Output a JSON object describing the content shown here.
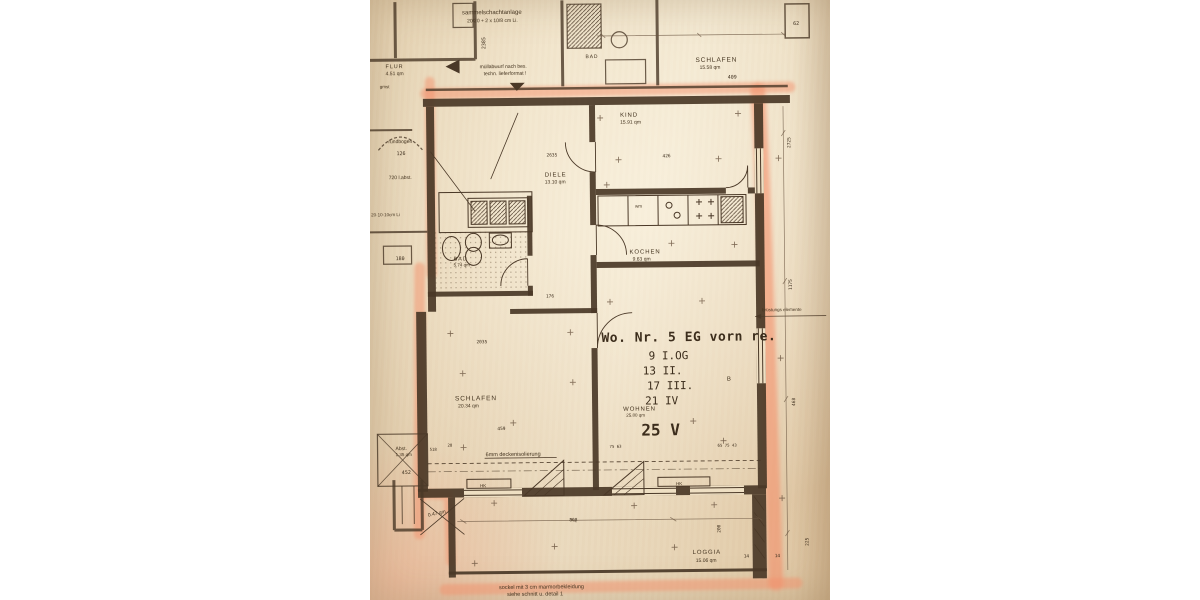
{
  "rooms": {
    "schlafen_top": {
      "name": "SCHLAFEN",
      "area": "15.58 qm"
    },
    "kind": {
      "name": "KIND",
      "area": "15.91 qm"
    },
    "diele": {
      "name": "DIELE",
      "area": "13.10 qm"
    },
    "kochen": {
      "name": "KOCHEN",
      "area": "9.63 qm"
    },
    "bad": {
      "name": "BAD",
      "area": "5.74 qm"
    },
    "bad_top": {
      "name": "BAD"
    },
    "schlafen": {
      "name": "SCHLAFEN",
      "area": "20.34 qm"
    },
    "wohnen": {
      "name": "WOHNEN",
      "area": "25.80 qm"
    },
    "loggia": {
      "name": "LOGGIA",
      "area": "15.06 qm"
    },
    "abst": {
      "name": "Abst.",
      "area": "1.35 qm"
    },
    "flur": {
      "name": "FLUR",
      "area": "4.51 qm"
    },
    "loggia_small": {
      "area": "0.47 qm"
    }
  },
  "title_block": {
    "title": "Wo. Nr. 5  EG vorn re.",
    "floor1": "9 I.OG",
    "floor2": "13 II.",
    "floor3": "17 III.",
    "floor4": "21 IV",
    "unit_count": "25 V",
    "marker": "B"
  },
  "notes": {
    "sammel1": "sammelschachtanlage",
    "sammel2": "20/20 + 2 x 10/8 cm Li.",
    "muell1": "müllabwurf nach bes.",
    "muell2": "techn. lieferformat !",
    "decken": "6mm deckenisolierung",
    "bruestung": "brüstungs elemente",
    "sockel1": "sockel mit 3 cm marmorbekleidung",
    "sockel2": "siehe schnitt u. detail 1",
    "rundbogen": "rundbogen",
    "labst": "720 l.abst.",
    "li": "20·10·10cm Li",
    "wm": "wm",
    "hk1": "HK",
    "hk2": "HK",
    "gmst": "gmst"
  },
  "dims": {
    "d2725": "2725",
    "d1175": "1175",
    "d468": "468",
    "d225": "225",
    "d2385": "2385",
    "d2635": "2635",
    "d2035": "2035",
    "d808": "808",
    "d459": "459",
    "d426": "426",
    "d176": "176",
    "d126": "126",
    "d180": "180",
    "d452": "452",
    "d200": "200",
    "d409": "409",
    "d62": "62",
    "d518": "518",
    "d28": "28",
    "d14a": "14",
    "d14b": "14",
    "w1": "75  63",
    "w2": "65 75 43"
  },
  "colors": {
    "paper": "#eedfc3",
    "ink": "#4a3827",
    "highlighter": "#f4916c"
  }
}
